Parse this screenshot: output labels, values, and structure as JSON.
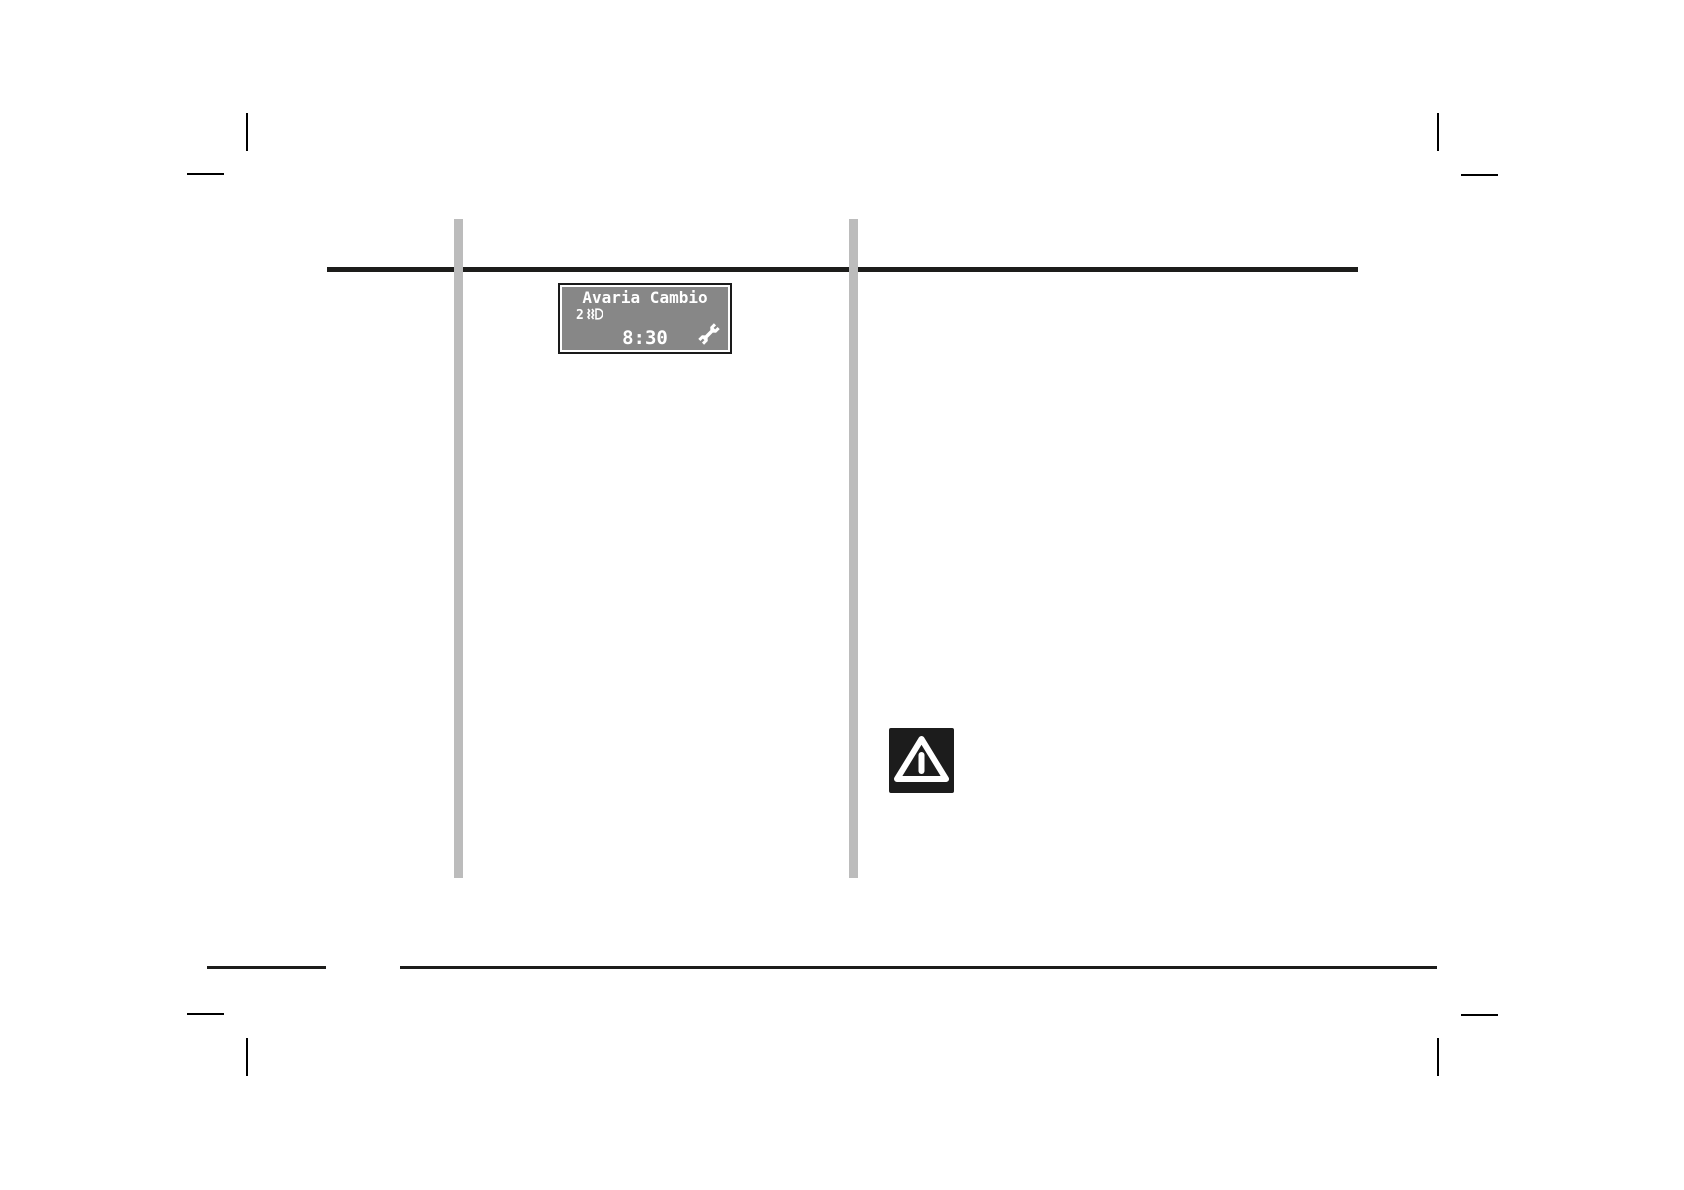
{
  "document": {
    "kind": "owner-manual-page",
    "language": "Italian"
  },
  "display": {
    "title": "Avaria Cambio",
    "gear_indicator": "2",
    "time": "8:30",
    "icons": {
      "beside_gear": "low-beam-headlight-icon",
      "bottom_right": "wrench-icon"
    },
    "colors": {
      "background": "#878787",
      "text": "#ffffff",
      "outer_frame": "#1a1a1a",
      "inner_frame": "#ffffff"
    }
  },
  "warning": {
    "icon": "warning-triangle-icon",
    "colors": {
      "background": "#1c1c1c",
      "foreground": "#ffffff"
    }
  },
  "rules": {
    "color": "#1d1d1b"
  },
  "column_bars": {
    "color": "#bcbcbc"
  }
}
